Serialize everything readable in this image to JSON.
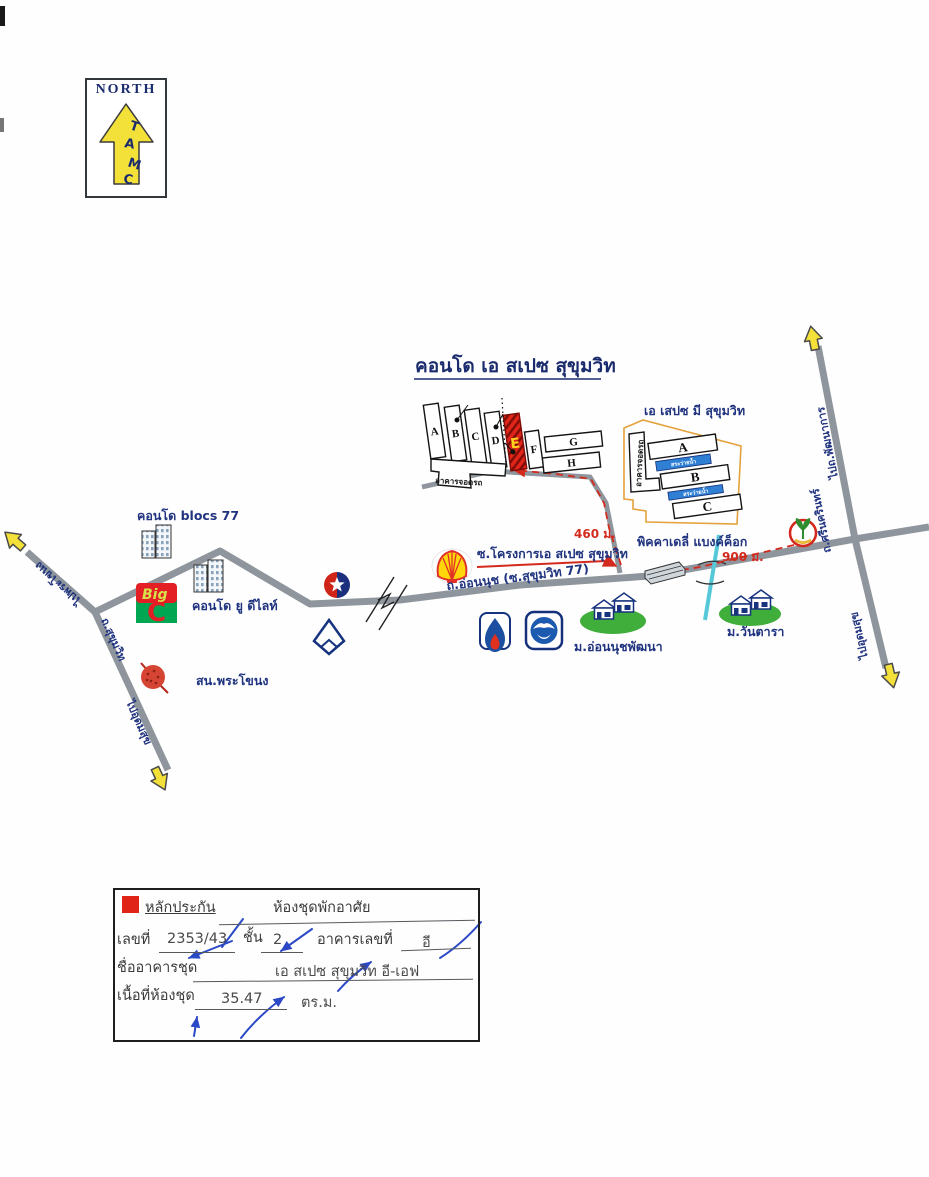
{
  "colors": {
    "navy_text": "#20337f",
    "road_gray": "#8e959c",
    "arrow_yellow": "#f3e13a",
    "route_red": "#d42a1e",
    "boundary_orange": "#e5a23c",
    "pool_blue": "#2f7fd4",
    "village_green": "#3fae3a",
    "canal_cyan": "#57c8d8",
    "pen_blue": "#2b49c6",
    "legend_red": "#e02418"
  },
  "north": {
    "title": "NORTH",
    "letters": [
      "T",
      "A",
      "M",
      "C"
    ]
  },
  "map": {
    "title": "คอนโด เอ สเปซ สุขุมวิท",
    "left_complex": {
      "buildings": [
        "A",
        "B",
        "C",
        "D",
        "E",
        "F",
        "G",
        "H"
      ],
      "parking_label": "อาคารจอดรถ"
    },
    "right_complex": {
      "title": "เอ เสปซ มี สุขุมวิท",
      "parking_label": "อาคารจอดรถ",
      "buildings": [
        "A",
        "B",
        "C"
      ],
      "pool_label": "สระว่ายน้ำ"
    },
    "roads": {
      "onnut": "ถ.อ่อนนุช (ซ.สุขุมวิท 77)",
      "soi_project": "ซ.โครงการเอ สเปซ สุขุมวิท",
      "to_phrakhanong": "ไปพระโขนง",
      "sukhumvit": "ถ.สุขุมวิท",
      "to_udomsuk_left": "ไปอุดมสุข",
      "to_phatthanakan": "ไปถ.พัฒนาการ",
      "srinakarin": "ถ.ศรีนครินทร์",
      "to_udomsuk_right": "ไปอุดมสุข"
    },
    "distances": {
      "to_condo": "460 ม.",
      "to_srinakarin": "900 ม."
    },
    "landmarks": {
      "blocs77": "คอนโด blocs 77",
      "udelight": "คอนโด ยู ดีไลท์",
      "bigc_big": "Big",
      "bigc_c": "C",
      "police": "สน.พระโขนง",
      "village_onnutpattana": "ม.อ่อนนุชพัฒนา",
      "village_wantara": "ม.วันตารา",
      "piccadilly": "พิคคาเดลี่ แบงค์ค็อก"
    }
  },
  "form": {
    "legend_label": "หลักประกัน",
    "type_label": "ห้องชุดพักอาศัย",
    "no_label": "เลขที่",
    "no_value": "2353/43",
    "floor_label": "ชั้น",
    "floor_value": "2",
    "building_no_label": "อาคารเลขที่",
    "building_no_value": "อี",
    "building_name_label": "ชื่ออาคารชุด",
    "building_name_value": "เอ สเปซ สุขุมวิท อี-เอฟ",
    "area_label": "เนื้อที่ห้องชุด",
    "area_value": "35.47",
    "area_unit": "ตร.ม."
  }
}
